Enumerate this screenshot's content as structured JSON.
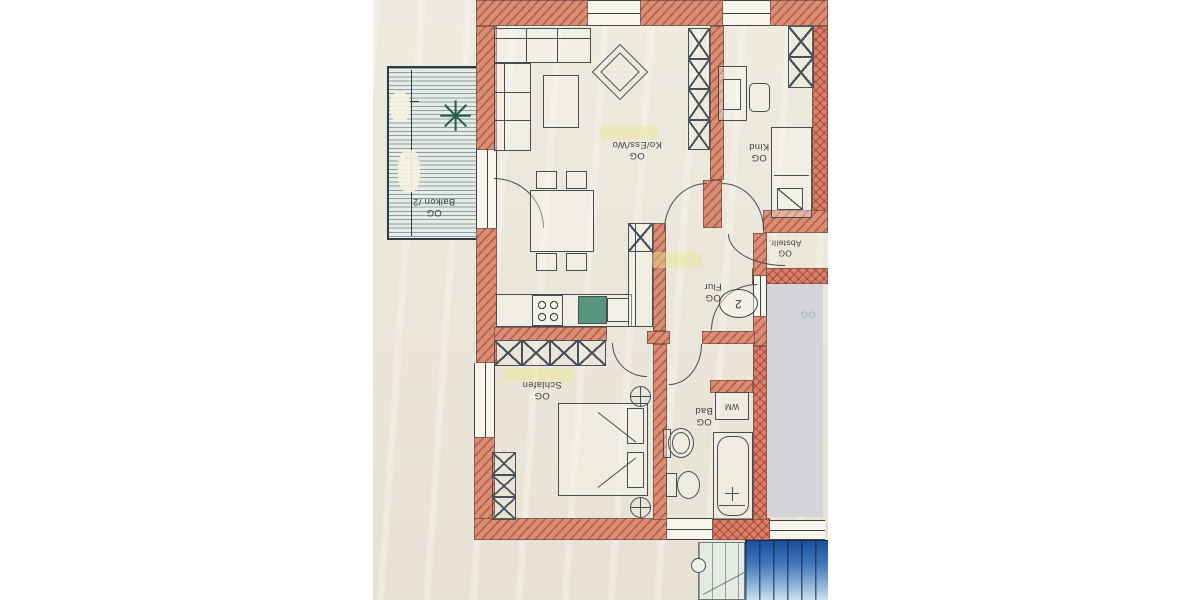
{
  "document": {
    "kind": "scanned apartment floor plan",
    "floor_tag": "OG"
  },
  "colors": {
    "paper": "#ebe6d8",
    "wall_fill": "#d98f76",
    "wall_hatch": "#9e3420",
    "line": "#454e55",
    "balcony_bg": "#e7ece6",
    "balcony_line": "#3e626c",
    "stairs_blue_dark": "#1c4f9c",
    "stairs_blue_light": "#cfe0ec",
    "stairwell_bg": "#d4d5d9",
    "sink_green": "#57967c",
    "highlight": "#ebe68c"
  },
  "rooms": {
    "balcony": {
      "floor": "OG",
      "name": "Balkon /2"
    },
    "living": {
      "floor": "OG",
      "name": "Ko/Ess/Wo"
    },
    "child": {
      "floor": "OG",
      "name": "Kind"
    },
    "storage": {
      "floor": "OG",
      "name": "Abstellr."
    },
    "hall": {
      "floor": "OG",
      "name": "Flur"
    },
    "bath": {
      "floor": "OG",
      "name": "Bad"
    },
    "bedroom": {
      "floor": "OG",
      "name": "Schlafen"
    },
    "stairwell": {
      "floor_faint": "OG"
    }
  },
  "annotations": {
    "apartment_number": "2",
    "washing_machine": "WM",
    "plant_glyph": "✳"
  }
}
